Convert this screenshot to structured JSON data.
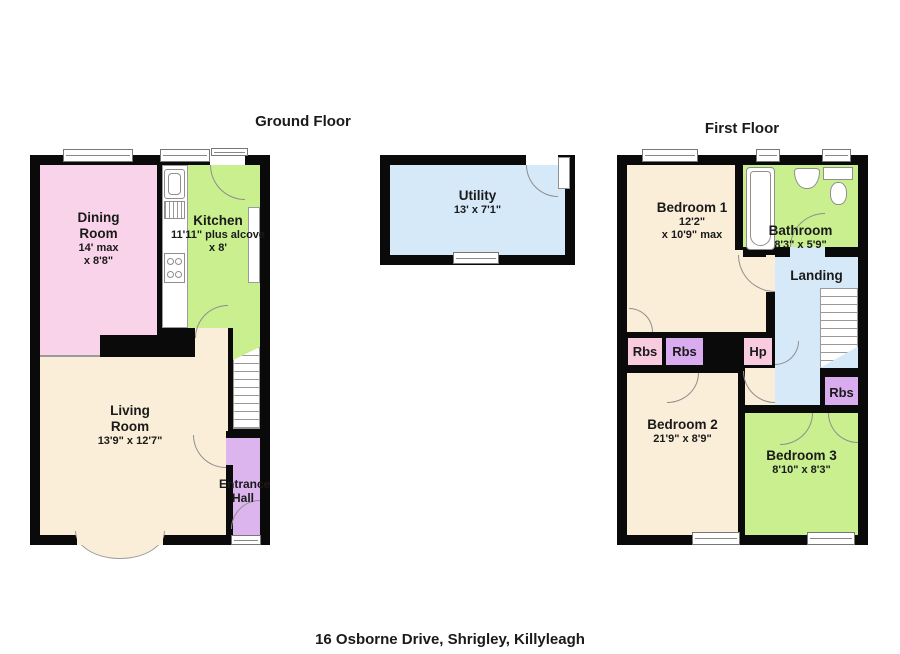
{
  "palette": {
    "wall": "#0a0a0a",
    "pink": "#f8d3e9",
    "green": "#c9ef8f",
    "cream": "#faeed8",
    "purple": "#dcb4ee",
    "rbs_pink": "#f9cbdf",
    "rbs_purple": "#d9abef",
    "blue": "#d6e9f8",
    "white": "#ffffff",
    "outline": "#8f8f8f"
  },
  "titles": {
    "ground": "Ground Floor",
    "first": "First Floor"
  },
  "caption": "16 Osborne Drive, Shrigley, Killyleagh",
  "ground_floor": {
    "dining": {
      "name": "Dining Room",
      "dims1": "14' max",
      "dims2": "x 8'8\""
    },
    "kitchen": {
      "name": "Kitchen",
      "dims1": "11'11\" plus alcove",
      "dims2": "x 8'"
    },
    "living": {
      "name": "Living Room",
      "dims": "13'9\" x 12'7\""
    },
    "entrance": {
      "name": "Entrance Hall"
    }
  },
  "utility": {
    "name": "Utility",
    "dims": "13' x 7'1\""
  },
  "first_floor": {
    "bedroom1": {
      "name": "Bedroom 1",
      "dims1": "12'2\"",
      "dims2": "x 10'9\" max"
    },
    "bathroom": {
      "name": "Bathroom",
      "dims": "8'3\" x 5'9\""
    },
    "landing": {
      "name": "Landing"
    },
    "bedroom2": {
      "name": "Bedroom 2",
      "dims": "21'9\" x 8'9\""
    },
    "bedroom3": {
      "name": "Bedroom 3",
      "dims": "8'10\" x 8'3\""
    },
    "cupboards": {
      "rbs1": "Rbs",
      "rbs2": "Rbs",
      "hp": "Hp",
      "rbs3": "Rbs"
    }
  }
}
